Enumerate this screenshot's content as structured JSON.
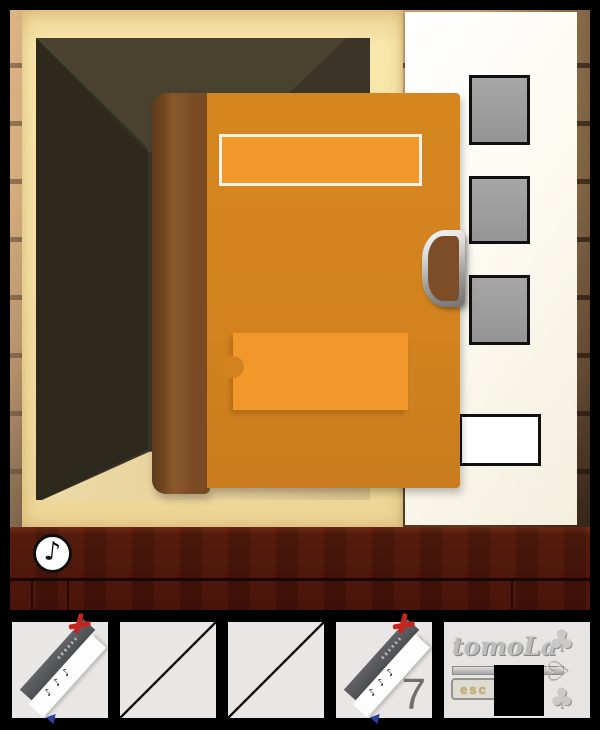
{
  "scene": {
    "description": "Open wooden closet with a large orange book propped in front; cream page panel on the right",
    "sound_button": {
      "icon": "music-note-icon",
      "glyph": "♪"
    }
  },
  "panel": {
    "gray_squares": 3,
    "white_card_slots": 1
  },
  "inventory": {
    "bookmark": {
      "name": "bookmark-with-red-ribbon",
      "notes_glyphs": "♪♪♪"
    },
    "slot4_count": "7",
    "credit": {
      "logo": "tomoLa",
      "badge": "esc",
      "key_club_glyph": "♣",
      "key_heart_glyph": "♡"
    }
  },
  "colors": {
    "book_orange": "#d2831f",
    "label_orange": "#f2982a",
    "page_white": "#fcf9f1",
    "frame_tan": "#f3e0a2",
    "interior_dark": "#3b3527",
    "dresser_maroon": "#4a150b",
    "square_gray": "#9d9d9d",
    "slot_gray": "#e8e7e5",
    "ribbon_red": "#c5251d",
    "bookmark_blue": "#2b3f9e"
  }
}
